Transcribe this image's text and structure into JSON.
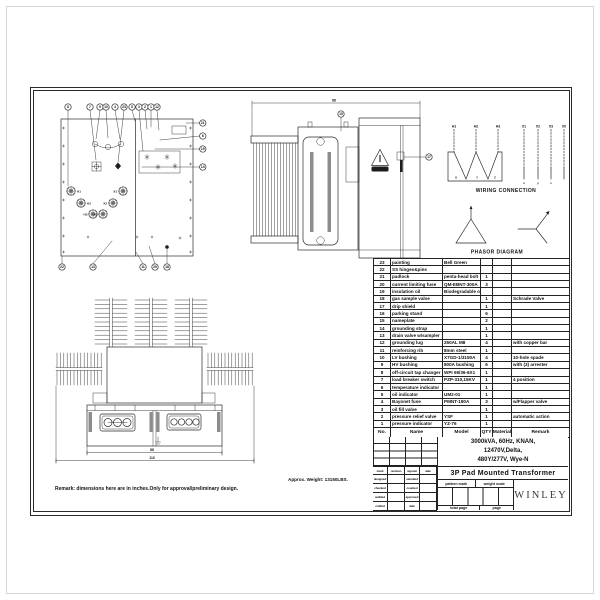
{
  "notes": {
    "remark": "Remark: dimensions here are in inches.Only for approval/preliminary design.",
    "weight": "Approx. Weight: 13150LBS."
  },
  "front_view": {
    "top_callouts": [
      "8",
      "7",
      "9",
      "10",
      "4",
      "23",
      "5",
      "3",
      "2",
      "1",
      "12"
    ],
    "right_callouts": [
      "21",
      "6",
      "19",
      "14"
    ],
    "bottom_callouts": [
      "22",
      "13",
      "11",
      "20",
      "18"
    ],
    "h_labels": [
      "H1",
      "H2",
      "H3"
    ],
    "x_labels": [
      "X1",
      "X2",
      "X3"
    ]
  },
  "side_view": {
    "top_callout": "15",
    "right_callout": "17",
    "top_dim": "88"
  },
  "plan_view": {
    "dim_inner": "88",
    "dim_outer": "110"
  },
  "wiring": {
    "title": "WIRING CONNECTION",
    "hv_terminals": [
      "H1",
      "H2",
      "H3"
    ],
    "hv_phase": [
      "X",
      "Y",
      "Z"
    ],
    "lv_terminals": [
      "X1",
      "X2",
      "X3",
      "X0"
    ],
    "lv_phase": [
      "x",
      "y",
      "z"
    ]
  },
  "phasor": {
    "title": "PHASOR DIAGRAM"
  },
  "parts_table": {
    "headers": [
      "No.",
      "Name",
      "Model",
      "QTY",
      "Material",
      "Remark"
    ],
    "rows": [
      [
        "23",
        "painting",
        "Bell Green",
        "",
        "",
        ""
      ],
      [
        "22",
        "SS hinges&pins",
        "",
        "",
        "",
        ""
      ],
      [
        "21",
        "padlock",
        "penta-head bolt",
        "1",
        "",
        ""
      ],
      [
        "20",
        "current limiting fuse",
        "QM-EBNT-300A",
        "3",
        "",
        ""
      ],
      [
        "19",
        "insulation oil",
        "Biodegradable oil",
        "",
        "",
        ""
      ],
      [
        "18",
        "gas sample valve",
        "",
        "1",
        "",
        "Schrade Valve"
      ],
      [
        "17",
        "drip shield",
        "",
        "1",
        "",
        ""
      ],
      [
        "16",
        "parking stand",
        "",
        "6",
        "",
        ""
      ],
      [
        "15",
        "nameplate",
        "",
        "2",
        "",
        ""
      ],
      [
        "14",
        "grounding strap",
        "",
        "1",
        "",
        ""
      ],
      [
        "13",
        "drain valve w/sampler",
        "",
        "1",
        "",
        ""
      ],
      [
        "12",
        "grounding lug",
        "250AL M8",
        "4",
        "",
        "with copper bar"
      ],
      [
        "11",
        "reinforcing rib",
        "8mm steel",
        "1",
        "",
        ""
      ],
      [
        "10",
        "LV bushing",
        "X7GD-1/3150A",
        "4",
        "",
        "10-hole spade"
      ],
      [
        "9",
        "HV bushing",
        "800A bushing",
        "6",
        "",
        "with (3) arrester"
      ],
      [
        "8",
        "off-circuit tap changer",
        "WPI 69/36-6X1",
        "1",
        "",
        ""
      ],
      [
        "7",
        "load breaker switch",
        "PZP-310,15KV",
        "1",
        "",
        "4 position"
      ],
      [
        "6",
        "temperature indicator",
        "",
        "1",
        "",
        ""
      ],
      [
        "5",
        "oil indicator",
        "UM2-01",
        "1",
        "",
        ""
      ],
      [
        "4",
        "Bayonet fuse",
        "PMNT-180A",
        "3",
        "",
        "w/Flapper valve"
      ],
      [
        "3",
        "oil fill valve",
        "",
        "1",
        "",
        ""
      ],
      [
        "2",
        "pressure relief valve",
        "YSF",
        "1",
        "",
        "automatic action"
      ],
      [
        "1",
        "pressure indicator",
        "YZ-76",
        "1",
        "",
        ""
      ]
    ]
  },
  "title_block": {
    "specs": [
      "3000kVA, 60Hz, KNAN,",
      "12470V,Delta,",
      "480Y/277V, Wye-N"
    ],
    "drawing_title": "3P Pad Mounted Transformer",
    "company": "WINLEY",
    "rev_headers": [
      "mark",
      "revision",
      "signum",
      "date"
    ],
    "rows_left": [
      "designed",
      "checked",
      "audited",
      "crafted"
    ],
    "rows_right": [
      "standard",
      "counted",
      "approved",
      "date"
    ],
    "pattern_mark": "pattern mark",
    "weight_scale": "weight scale",
    "total_page": "total page",
    "page": "page"
  }
}
